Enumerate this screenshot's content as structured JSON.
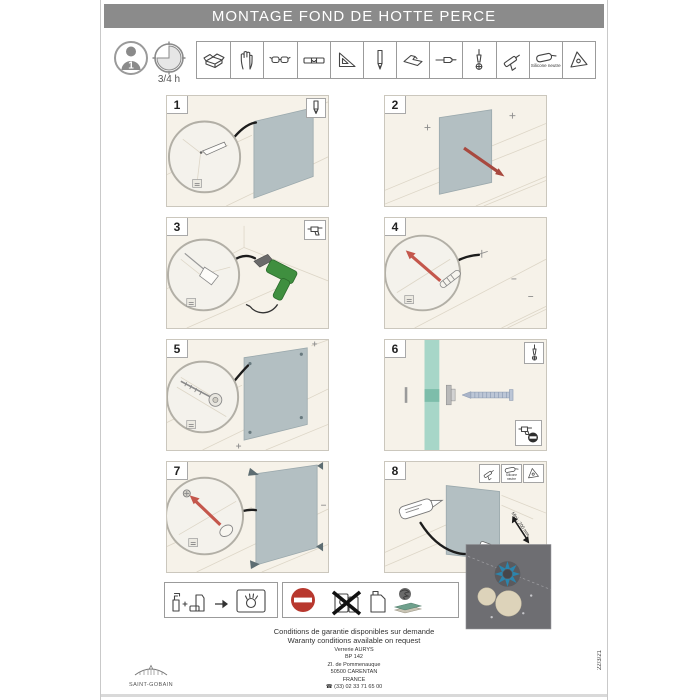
{
  "page": {
    "title": "MONTAGE FOND DE HOTTE PERCE",
    "date_code": "22/3/21"
  },
  "prep": {
    "people_count": "1",
    "duration_label": "3/4 h"
  },
  "tools": {
    "items": [
      {
        "icon": "toolbox-icon",
        "label": ""
      },
      {
        "icon": "glove-icon",
        "label": ""
      },
      {
        "icon": "safety-glasses-icon",
        "label": ""
      },
      {
        "icon": "spirit-level-icon",
        "label": ""
      },
      {
        "icon": "square-ruler-icon",
        "label": ""
      },
      {
        "icon": "pencil-icon",
        "label": ""
      },
      {
        "icon": "cutter-icon",
        "label": ""
      },
      {
        "icon": "drill-bit-icon",
        "label": ""
      },
      {
        "icon": "phillips-screwdriver-icon",
        "label": ""
      },
      {
        "icon": "caulk-gun-icon",
        "label": ""
      },
      {
        "icon": "silicone-tube-icon",
        "label": "Silicone neutre"
      },
      {
        "icon": "triangle-spreader-icon",
        "label": ""
      }
    ]
  },
  "steps": [
    {
      "number": "1",
      "tool_icons": [
        "pencil-icon"
      ]
    },
    {
      "number": "2",
      "tool_icons": []
    },
    {
      "number": "3",
      "tool_icons": [
        "drill-icon"
      ]
    },
    {
      "number": "4",
      "tool_icons": []
    },
    {
      "number": "5",
      "tool_icons": []
    },
    {
      "number": "6",
      "tool_icons": [
        "phillips-screwdriver-icon"
      ],
      "warning_icon": "no-drill-icon"
    },
    {
      "number": "7",
      "tool_icons": []
    },
    {
      "number": "8",
      "tool_icons": [
        "caulk-gun-icon",
        "silicone-tube-icon",
        "triangle-spreader-icon"
      ],
      "silicone_label": "Silicone neutre",
      "min_distance_label": "Mini : 200 mm"
    }
  ],
  "footer": {
    "warranty_fr": "Conditions de garantie disponibles sur demande",
    "warranty_en": "Waranty conditions available on request",
    "address": [
      "Verrerie AURYS",
      "BP 142",
      "ZI. de Pommenauque",
      "50500 CARENTAN",
      "FRANCE",
      "☎ (33) 02 33 71 65 00"
    ],
    "brand": "SAINT-GOBAIN"
  }
}
